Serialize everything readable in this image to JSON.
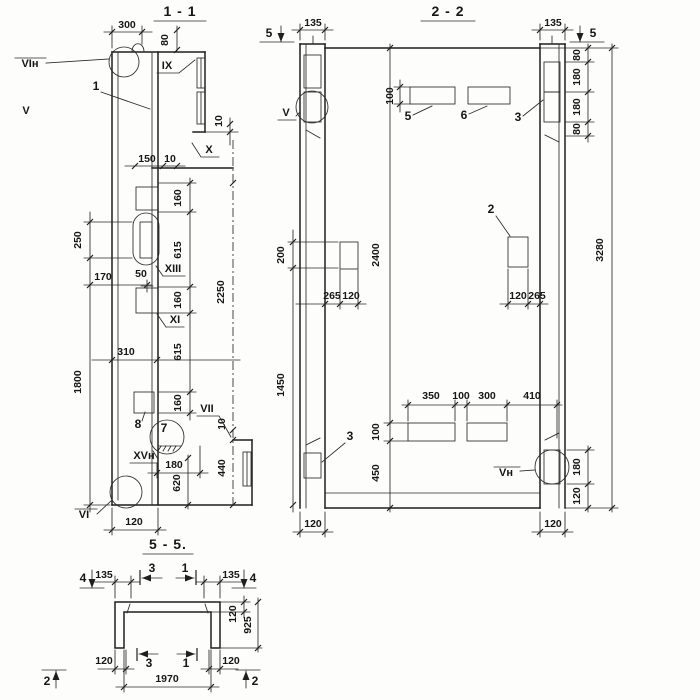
{
  "page": {
    "background": "#fdfdfb",
    "ink": "#1f1f1f"
  },
  "sections": {
    "s11": {
      "title": "1 - 1",
      "dims": {
        "d300": "300",
        "d80": "80",
        "d10_step": "10",
        "d150": "150",
        "d10_w": "10",
        "d160a": "160",
        "d615a": "615",
        "d160b": "160",
        "d615b": "615",
        "d160c": "160",
        "d2250": "2250",
        "d250": "250",
        "d170": "170",
        "d50": "50",
        "d1800": "1800",
        "d310": "310",
        "d180": "180",
        "d620": "620",
        "d440": "440",
        "d10_b": "10",
        "d120": "120"
      },
      "nodes": {
        "vin": "VIн",
        "ix": "IX",
        "x": "X",
        "xiii": "XIII",
        "xi": "XI",
        "vii": "VII",
        "xvn": "XVн",
        "vi": "VI"
      },
      "parts": {
        "p1": "1",
        "p7": "7",
        "p8": "8"
      }
    },
    "s22": {
      "title": "2 - 2",
      "dims": {
        "d135l": "135",
        "d135r": "135",
        "d80a": "80",
        "d180a": "180",
        "d180b": "180",
        "d80b": "80",
        "d3280": "3280",
        "d100t": "100",
        "d120_p2": "120",
        "d265_p2": "265",
        "d265_lp": "265",
        "d120_lp": "120",
        "d200": "200",
        "d2400": "2400",
        "d1450": "1450",
        "d100b": "100",
        "d450": "450",
        "d350": "350",
        "d100m": "100",
        "d300": "300",
        "d410": "410",
        "d180r": "180",
        "d120ch": "120",
        "d120_cl": "120",
        "d120_cr": "120"
      },
      "nodes": {
        "v": "V",
        "vn": "Vн"
      },
      "parts": {
        "p2": "2",
        "p3t": "3",
        "p3b": "3",
        "p5": "5",
        "p6": "6"
      },
      "marks": {
        "m5l": "5",
        "m5r": "5"
      }
    },
    "s55": {
      "title": "5 - 5.",
      "dims": {
        "d135l": "135",
        "d135r": "135",
        "d120w": "120",
        "d925": "925",
        "d120bl": "120",
        "d1970": "1970",
        "d120br": "120"
      },
      "marks": {
        "m4l": "4",
        "m4r": "4",
        "m3t": "3",
        "m1t": "1",
        "m3b": "3",
        "m1b": "1",
        "m2l": "2",
        "m2r": "2"
      }
    }
  }
}
